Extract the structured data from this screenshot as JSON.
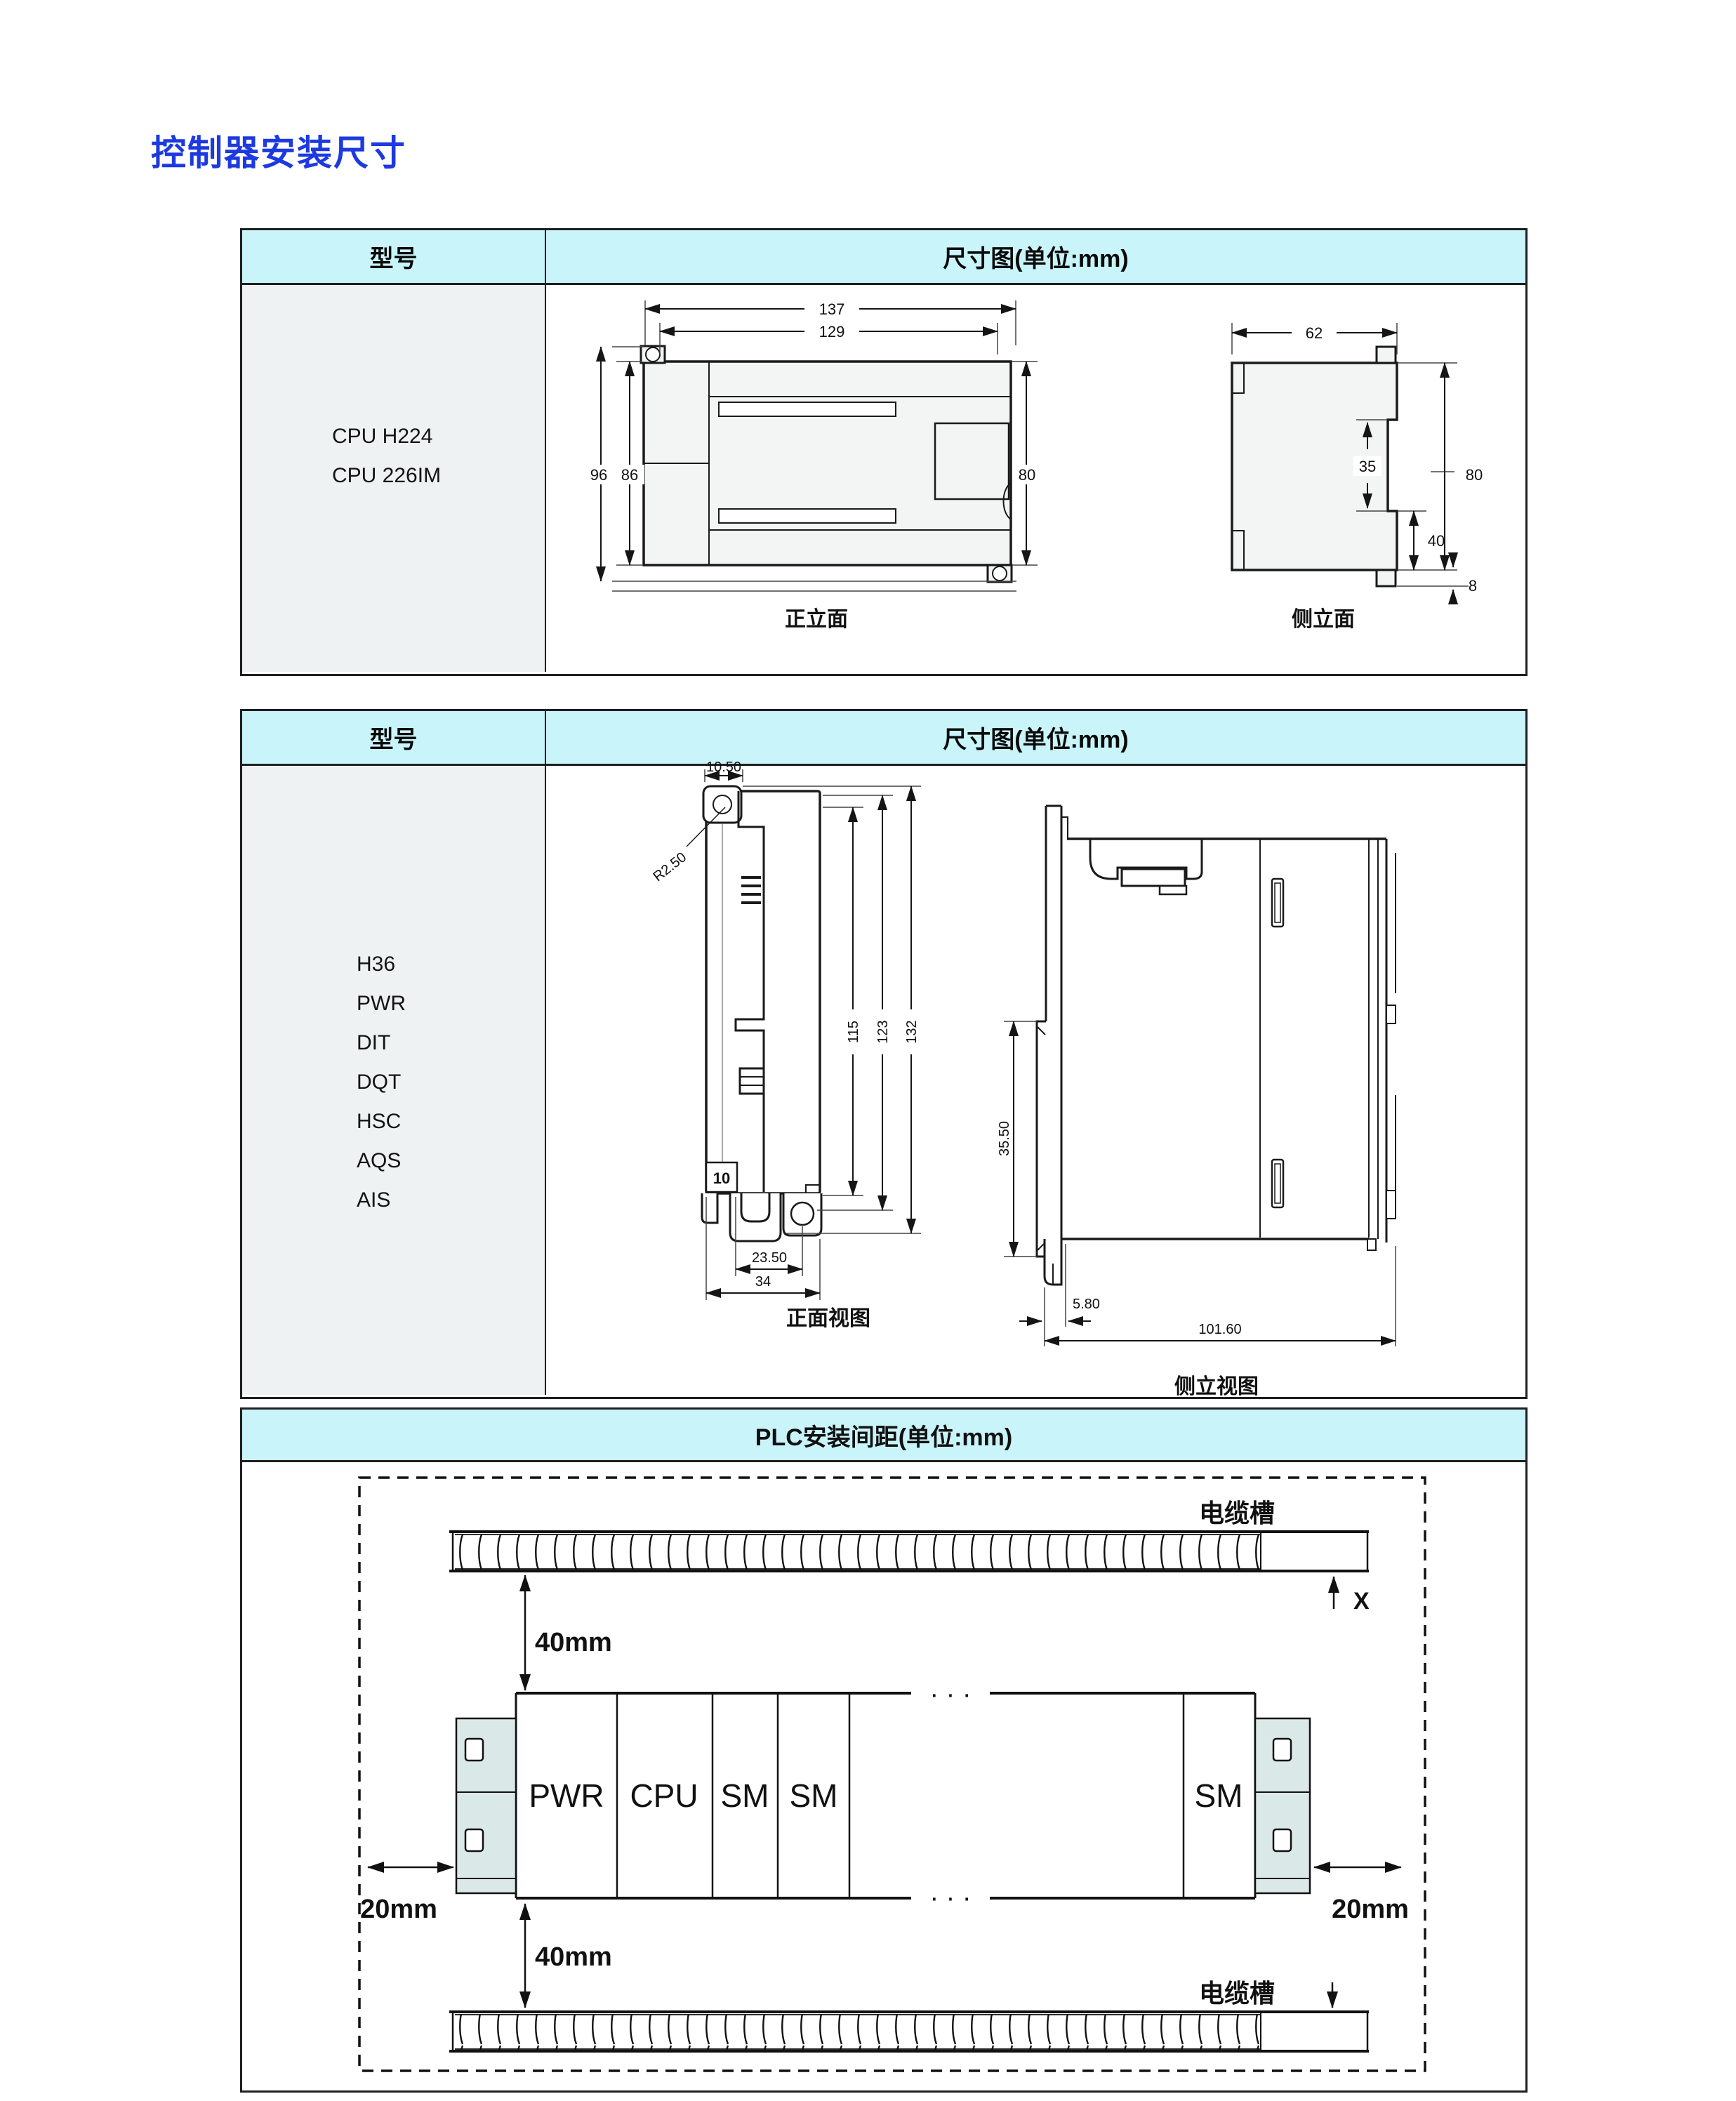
{
  "title": "控制器安装尺寸",
  "colors": {
    "accent_blue": "#1c3ae0",
    "header_bg": "#c9f4f9",
    "model_cell_bg": "#eef2f2",
    "line": "#1f1f1f"
  },
  "table1": {
    "col_model": "型号",
    "col_dim": "尺寸图(单位:mm)",
    "models": [
      "CPU H224",
      "CPU 226IM"
    ],
    "front": {
      "caption": "正立面",
      "w_outer": "137",
      "w_inner": "129",
      "h_outer": "96",
      "h_inner": "86",
      "h_right": "80"
    },
    "side": {
      "caption": "侧立面",
      "w": "62",
      "notch": "35",
      "h": "80",
      "h_lower": "40",
      "tab": "8"
    }
  },
  "table2": {
    "col_model": "型号",
    "col_dim": "尺寸图(单位:mm)",
    "models": [
      "H36",
      "PWR",
      "DIT",
      "DQT",
      "HSC",
      "AQS",
      "AIS"
    ],
    "front": {
      "caption": "正面视图",
      "ear_w": "10.50",
      "radius": "R2.50",
      "h1": "115",
      "h2": "123",
      "h3": "132",
      "tag": "10",
      "w1": "23.50",
      "w2": "34"
    },
    "side": {
      "caption": "侧立视图",
      "clip_h": "35.50",
      "foot_w": "5.80",
      "depth": "101.60"
    }
  },
  "spacing": {
    "header": "PLC安装间距(单位:mm)",
    "tray_top_label": "电缆槽",
    "tray_bottom_label": "电缆槽",
    "x_marker": "X",
    "top_gap": "40mm",
    "bottom_gap": "40mm",
    "left_gap": "20mm",
    "right_gap": "20mm",
    "modules": [
      "PWR",
      "CPU",
      "SM",
      "SM",
      "SM"
    ],
    "dots": "· · ·"
  }
}
